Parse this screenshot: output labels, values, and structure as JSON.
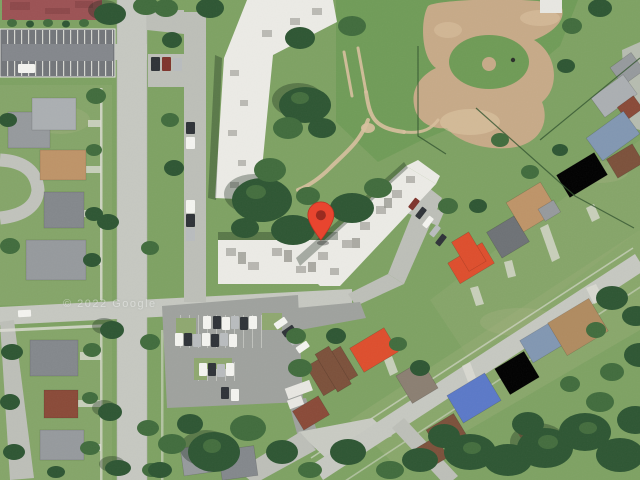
{
  "map": {
    "view_type": "satellite-imagery",
    "watermark": "© 2022 Google",
    "marker": {
      "color": "#E8452F",
      "inner_color": "#9A2B20",
      "tip_x": 321,
      "tip_y": 241
    }
  },
  "palette": {
    "grass": "#7EA263",
    "park": "#6F9B56",
    "lawn": "#93AB74",
    "lawn2": "#8FA870",
    "pale": "#A9B286",
    "tree1": "#2E5633",
    "tree2": "#416C3D",
    "tree3": "#5A8549",
    "road": "#C6C8C1",
    "roadold": "#BDBFB8",
    "plaza": "#C9CBC3",
    "sidewalk": "#DEDED6",
    "lot1": "#73767A",
    "lot1b": "#84878C",
    "lot2": "#9FA29E",
    "dirt": "#C7AA88",
    "dirt2": "#D8C09E",
    "white1": "#ECEBE6",
    "speck": "#AFAFA8",
    "speck2": "#9B9B93",
    "redbld": "#9C5254",
    "redbld2": "#7E3E40",
    "shed": "#E8E7E2",
    "roofred": "#DE4E2D",
    "roofmaroon": "#8A4A38",
    "roofbrown": "#7C513B",
    "rooftan": "#BE9468",
    "rooftan2": "#B08B60",
    "roofgray": "#969A9D",
    "roofgray2": "#84888C",
    "roofgraylight": "#ABAFB2",
    "roofdark": "#6E7276",
    "roofblue": "#5B79C8",
    "roofbluegray": "#8297B2",
    "roofkhaki": "#8B7F72",
    "carw": "#F4F4F0",
    "cark": "#2F3338",
    "cars": "#B9BCBE",
    "carr": "#7E342C",
    "fence": "#33552F",
    "shadowc": "rgba(15,35,20,0.32)"
  }
}
